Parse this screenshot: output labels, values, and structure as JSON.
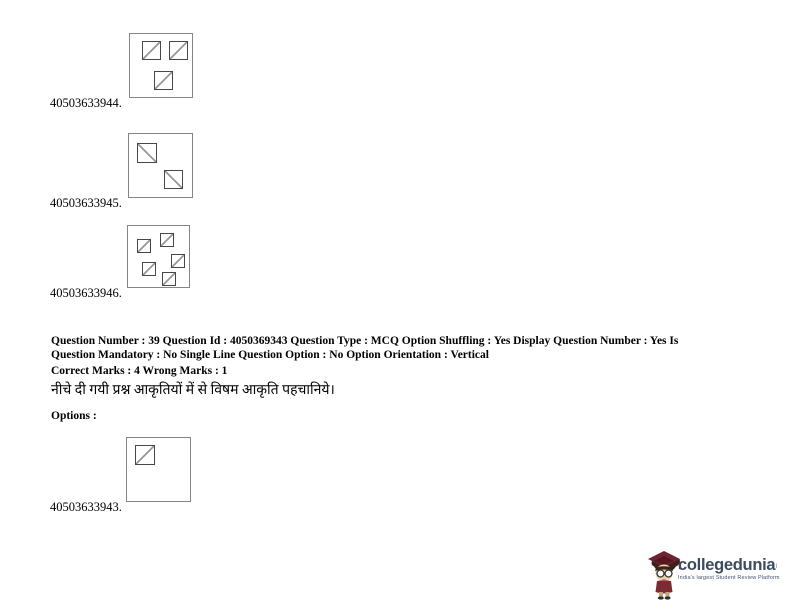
{
  "figures": [
    {
      "label": "40503633944.",
      "box": {
        "left": 129,
        "top": 33,
        "width": 64,
        "height": 65
      },
      "squares": [
        {
          "x": 12,
          "y": 7,
          "size": 19,
          "diag": "up"
        },
        {
          "x": 39,
          "y": 7,
          "size": 19,
          "diag": "up"
        },
        {
          "x": 24,
          "y": 37,
          "size": 19,
          "diag": "up"
        }
      ]
    },
    {
      "label": "40503633945.",
      "box": {
        "left": 128,
        "top": 133,
        "width": 65,
        "height": 65
      },
      "squares": [
        {
          "x": 8,
          "y": 9,
          "size": 20,
          "diag": "down"
        },
        {
          "x": 35,
          "y": 36,
          "size": 19,
          "diag": "down"
        }
      ]
    },
    {
      "label": "40503633946.",
      "box": {
        "left": 127,
        "top": 225,
        "width": 63,
        "height": 63
      },
      "squares": [
        {
          "x": 9,
          "y": 13,
          "size": 14,
          "diag": "up"
        },
        {
          "x": 32,
          "y": 7,
          "size": 14,
          "diag": "up"
        },
        {
          "x": 43,
          "y": 28,
          "size": 14,
          "diag": "up"
        },
        {
          "x": 14,
          "y": 36,
          "size": 14,
          "diag": "up"
        },
        {
          "x": 34,
          "y": 46,
          "size": 14,
          "diag": "up"
        }
      ]
    },
    {
      "label": "40503633943.",
      "box": {
        "left": 126,
        "top": 437,
        "width": 65,
        "height": 65
      },
      "squares": [
        {
          "x": 8,
          "y": 7,
          "size": 20,
          "diag": "up"
        }
      ]
    }
  ],
  "metadata": {
    "line1": "Question Number : 39 Question Id : 4050369343 Question Type : MCQ Option Shuffling : Yes Display Question Number : Yes Is",
    "line2": "Question Mandatory : No Single Line Question Option : No Option Orientation : Vertical",
    "marks": "Correct Marks : 4 Wrong Marks : 1"
  },
  "question": {
    "text_hi": "नीचे दी गयी प्रश्न आकृतियों में से विषम आकृति पहचानिये।",
    "options_label": "Options :"
  },
  "logo": {
    "brand": "collegedunia",
    "mark": "ı",
    "tagline": "India's largest Student Review Platform",
    "brand_color": "#3c4b5d"
  },
  "colors": {
    "outer_box_border": "#858585",
    "inner_square_border": "#474747",
    "diagonal_line": "#979797",
    "text": "#000000"
  }
}
